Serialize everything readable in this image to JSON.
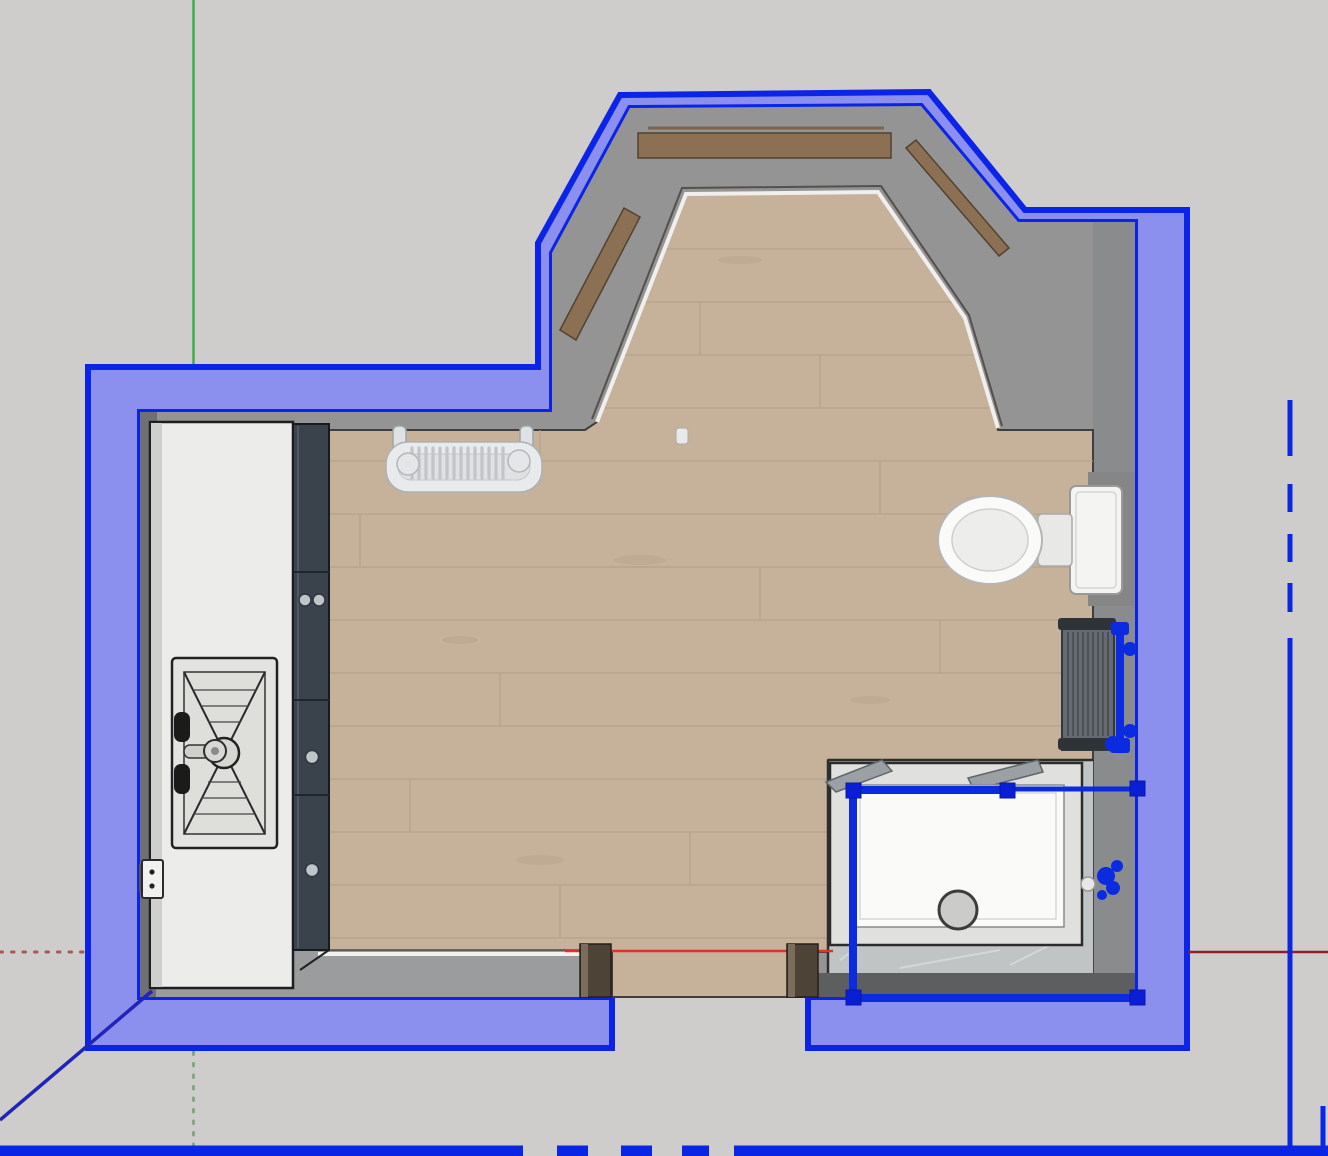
{
  "viewport": {
    "type": "3d-modeling-viewport",
    "view": "top-down plan view",
    "width": 1328,
    "height": 1156,
    "selection_active": true
  },
  "colors": {
    "background": "#cecdcc",
    "wall_fill": "#8b90ee",
    "selection_stroke": "#0c24e8",
    "selection_handle": "#0a1ed6",
    "inner_wall": "#949494",
    "wood": "#c6b29a",
    "wood_line": "#b3a08a",
    "marble": "#c0c4c5",
    "counter": "#ececeb",
    "cabinet": "#3a424b",
    "fixture_white": "#fafaf9",
    "sill_brown": "#8b7054",
    "jamb_brown": "#4e4337",
    "axis_green": "#3fae49",
    "axis_red": "#e03227",
    "axis_red_negative": "#8e2025",
    "axis_blue": "#2024b8"
  },
  "axes": {
    "green_axis": {
      "orientation": "vertical",
      "solid_above_model": true,
      "dotted_below_model": true
    },
    "red_axis": {
      "orientation": "horizontal",
      "dotted_left": true,
      "solid_right": true
    },
    "blue_axis": {
      "orientation": "diagonal-bottom-left",
      "solid": true
    }
  },
  "scene": {
    "objects": [
      {
        "name": "bathroom-wall-group",
        "selected": true,
        "shape": "room ring with bay window and doorway gap"
      },
      {
        "name": "bay-window-sills",
        "material": "wood-brown",
        "count": 3
      },
      {
        "name": "wood-floor",
        "material": "oak-planks"
      },
      {
        "name": "marble-floor-area",
        "material": "grey-marble"
      },
      {
        "name": "vanity-counter",
        "material": "white"
      },
      {
        "name": "sink",
        "features": [
          "basin",
          "faucet",
          "drain"
        ]
      },
      {
        "name": "tall-cabinet",
        "material": "charcoal",
        "knobs": 4
      },
      {
        "name": "towel-radiator",
        "material": "white",
        "mounted": "top wall"
      },
      {
        "name": "toilet",
        "parts": [
          "bowl",
          "seat-hinge",
          "cistern"
        ]
      },
      {
        "name": "wall-radiator",
        "mounted": "right wall",
        "selected_edges": true
      },
      {
        "name": "shower-enclosure",
        "selected": true,
        "parts": [
          "frame",
          "tray",
          "drain",
          "valve"
        ]
      },
      {
        "name": "door-jambs",
        "count": 2,
        "location": "bottom doorway"
      },
      {
        "name": "power-socket",
        "location": "left wall"
      }
    ]
  }
}
